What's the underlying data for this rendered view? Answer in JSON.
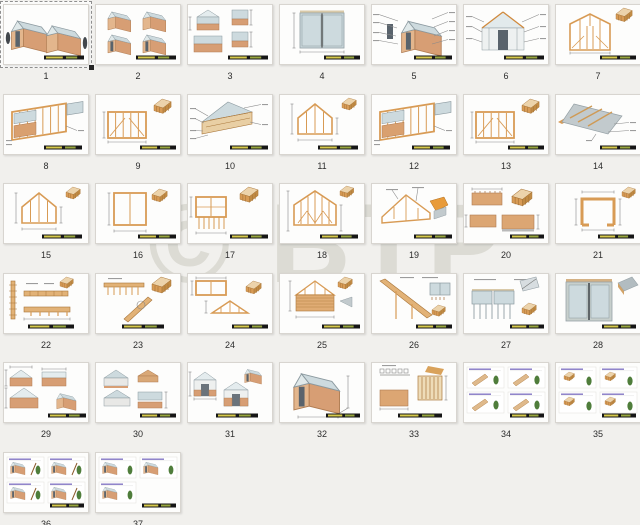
{
  "window": {
    "background": "#f1f0ed"
  },
  "watermark": {
    "text": "© BTP"
  },
  "grid": {
    "columns": 7,
    "page_count": 37
  },
  "selected_page": "1",
  "palette": {
    "wood": "#d89b55",
    "wood_dark": "#a9763a",
    "brick": "#d79e74",
    "brick_dark": "#b07c52",
    "glass": "#cddade",
    "glass_edge": "#8c9aa0",
    "door_dark": "#59636c",
    "dim_line": "#8a8a8a",
    "roof_gray": "#c2cacd",
    "roof_gray_dark": "#97a2a7",
    "plant_green": "#4f7d3b",
    "step_heading": "#8578c4",
    "titlebar_black": "#161616",
    "titlebar_yellow": "#d6c94b",
    "titlebar_olive": "#97a53d"
  },
  "pages": [
    {
      "number": "1",
      "kind": "iso-two",
      "selected": true
    },
    {
      "number": "2",
      "kind": "iso-four",
      "selected": false
    },
    {
      "number": "3",
      "kind": "elev-four",
      "selected": false
    },
    {
      "number": "4",
      "kind": "window",
      "selected": false
    },
    {
      "number": "5",
      "kind": "exploded",
      "selected": false
    },
    {
      "number": "6",
      "kind": "front-door",
      "selected": false
    },
    {
      "number": "7",
      "kind": "framing-door",
      "selected": false
    },
    {
      "number": "8",
      "kind": "wall-iso",
      "selected": false
    },
    {
      "number": "9",
      "kind": "frame-inset",
      "selected": false
    },
    {
      "number": "10",
      "kind": "gable-iso",
      "selected": false
    },
    {
      "number": "11",
      "kind": "gable-dims",
      "selected": false
    },
    {
      "number": "12",
      "kind": "wall-iso",
      "selected": false
    },
    {
      "number": "13",
      "kind": "frame-inset",
      "selected": false
    },
    {
      "number": "14",
      "kind": "roof-iso",
      "selected": false
    },
    {
      "number": "15",
      "kind": "gable-dims",
      "selected": false
    },
    {
      "number": "16",
      "kind": "rect-frame",
      "selected": false
    },
    {
      "number": "17",
      "kind": "frame-elev2",
      "selected": false
    },
    {
      "number": "18",
      "kind": "gable-truss",
      "selected": false
    },
    {
      "number": "19",
      "kind": "gable-detail",
      "selected": false
    },
    {
      "number": "20",
      "kind": "panels",
      "selected": false
    },
    {
      "number": "21",
      "kind": "plan",
      "selected": false
    },
    {
      "number": "22",
      "kind": "beam-details",
      "selected": false
    },
    {
      "number": "23",
      "kind": "plate-detail",
      "selected": false
    },
    {
      "number": "24",
      "kind": "wall-gable",
      "selected": false
    },
    {
      "number": "25",
      "kind": "gable-slats",
      "selected": false
    },
    {
      "number": "26",
      "kind": "rafter",
      "selected": false
    },
    {
      "number": "27",
      "kind": "glazing",
      "selected": false
    },
    {
      "number": "28",
      "kind": "big-window",
      "selected": false
    },
    {
      "number": "29",
      "kind": "multi-elev",
      "selected": false
    },
    {
      "number": "30",
      "kind": "gable-glaze",
      "selected": false
    },
    {
      "number": "31",
      "kind": "door-elev",
      "selected": false
    },
    {
      "number": "32",
      "kind": "iso-dims",
      "selected": false
    },
    {
      "number": "33",
      "kind": "brick-detail",
      "selected": false
    },
    {
      "number": "34",
      "kind": "steps-a",
      "selected": false
    },
    {
      "number": "35",
      "kind": "steps-b",
      "selected": false
    },
    {
      "number": "36",
      "kind": "steps-c",
      "selected": false
    },
    {
      "number": "37",
      "kind": "steps-3",
      "selected": false
    }
  ]
}
